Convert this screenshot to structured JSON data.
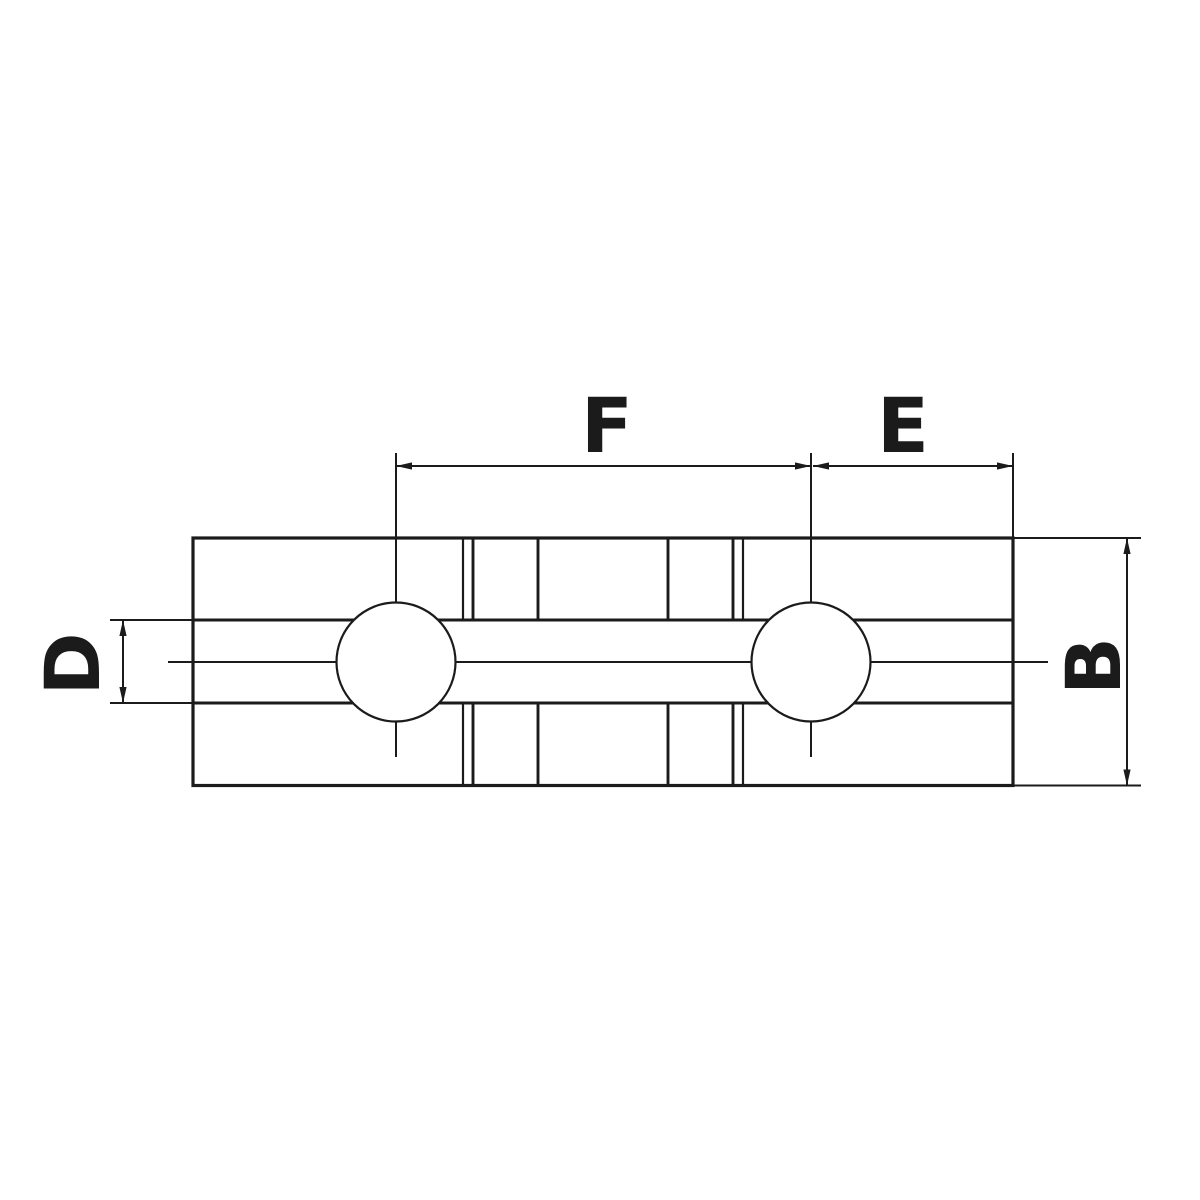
{
  "drawing": {
    "kind": "technical-dimension-drawing",
    "subject": "soft-jaw-top-view",
    "labels": {
      "f": "F",
      "e": "E",
      "d": "D",
      "b": "B"
    },
    "colors": {
      "line": "#1b1b1b",
      "background": "#ffffff"
    }
  }
}
